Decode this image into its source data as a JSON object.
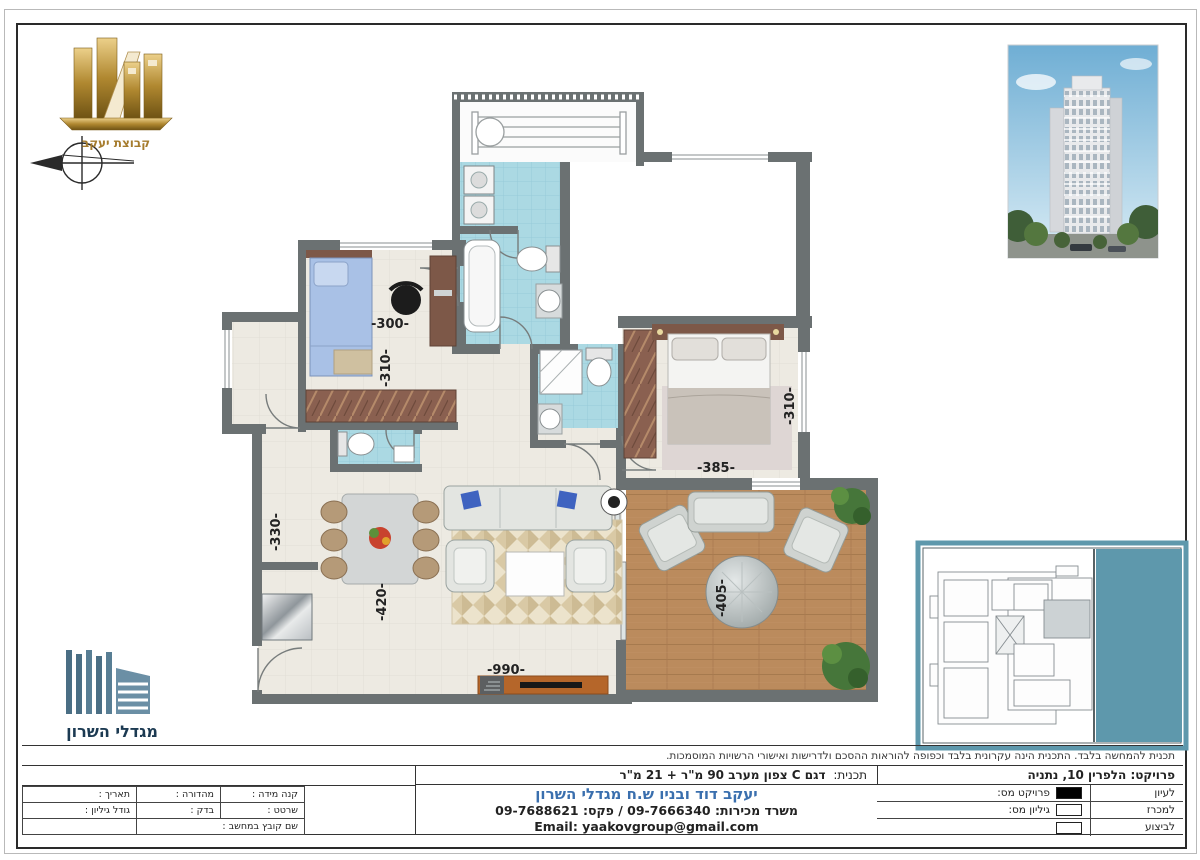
{
  "branding": {
    "group_logo_text": "קבוצת יעקב",
    "towers_logo_text": "מגדלי השרון"
  },
  "floorplan": {
    "dims": {
      "bedroom2_width": "-300-",
      "bedroom2_depth": "-310-",
      "master_width": "-385-",
      "master_depth": "-310-",
      "kitchen_width": "-330-",
      "living_depth": "-420-",
      "living_width": "-990-",
      "terrace_width": "-405-"
    }
  },
  "titleblock": {
    "disclaimer": "תכנית להמחשה בלבד. התכנית הינה עקרונית בלבד וכפופה להוראות ההסכם ולדרישות ואישורי הרשויות המוסמכות.",
    "project": "פרויקט: הלפרין 10, נתניה",
    "plan_label": "תכנית:",
    "plan_value": "דגם C צפון מערב 90 מ\"ר + 21 מ\"ר",
    "company": "יעקב דוד ובניו ש.ח מגדלי השרון",
    "sales": "משרד מכירות: 09-7666340 / פקס: 09-7688621",
    "email": "Email: yaakovgroup@gmail.com",
    "status": [
      {
        "label": "לעיון",
        "field": "פרויקט מס:",
        "checked": true
      },
      {
        "label": "למכרז",
        "field": "גיליון מס:",
        "checked": false
      },
      {
        "label": "לביצוע",
        "field": "",
        "checked": false
      }
    ],
    "meta": {
      "scale": "קנה מידה :",
      "edition": "מהדורה :",
      "date": "תאריך :",
      "drafter": "שרטט :",
      "checker": "בדק :",
      "sheet_size": "גודל גיליון :",
      "file_name": "שם קובץ במחשב :"
    }
  },
  "colors": {
    "wall": "#6b7172",
    "bath_tile": "#abd9e3",
    "deck_wood": "#bb8b5d",
    "keyplan_teal": "#5e98ac",
    "company_blue": "#3a6fae",
    "logo_gold": "#b08830"
  }
}
